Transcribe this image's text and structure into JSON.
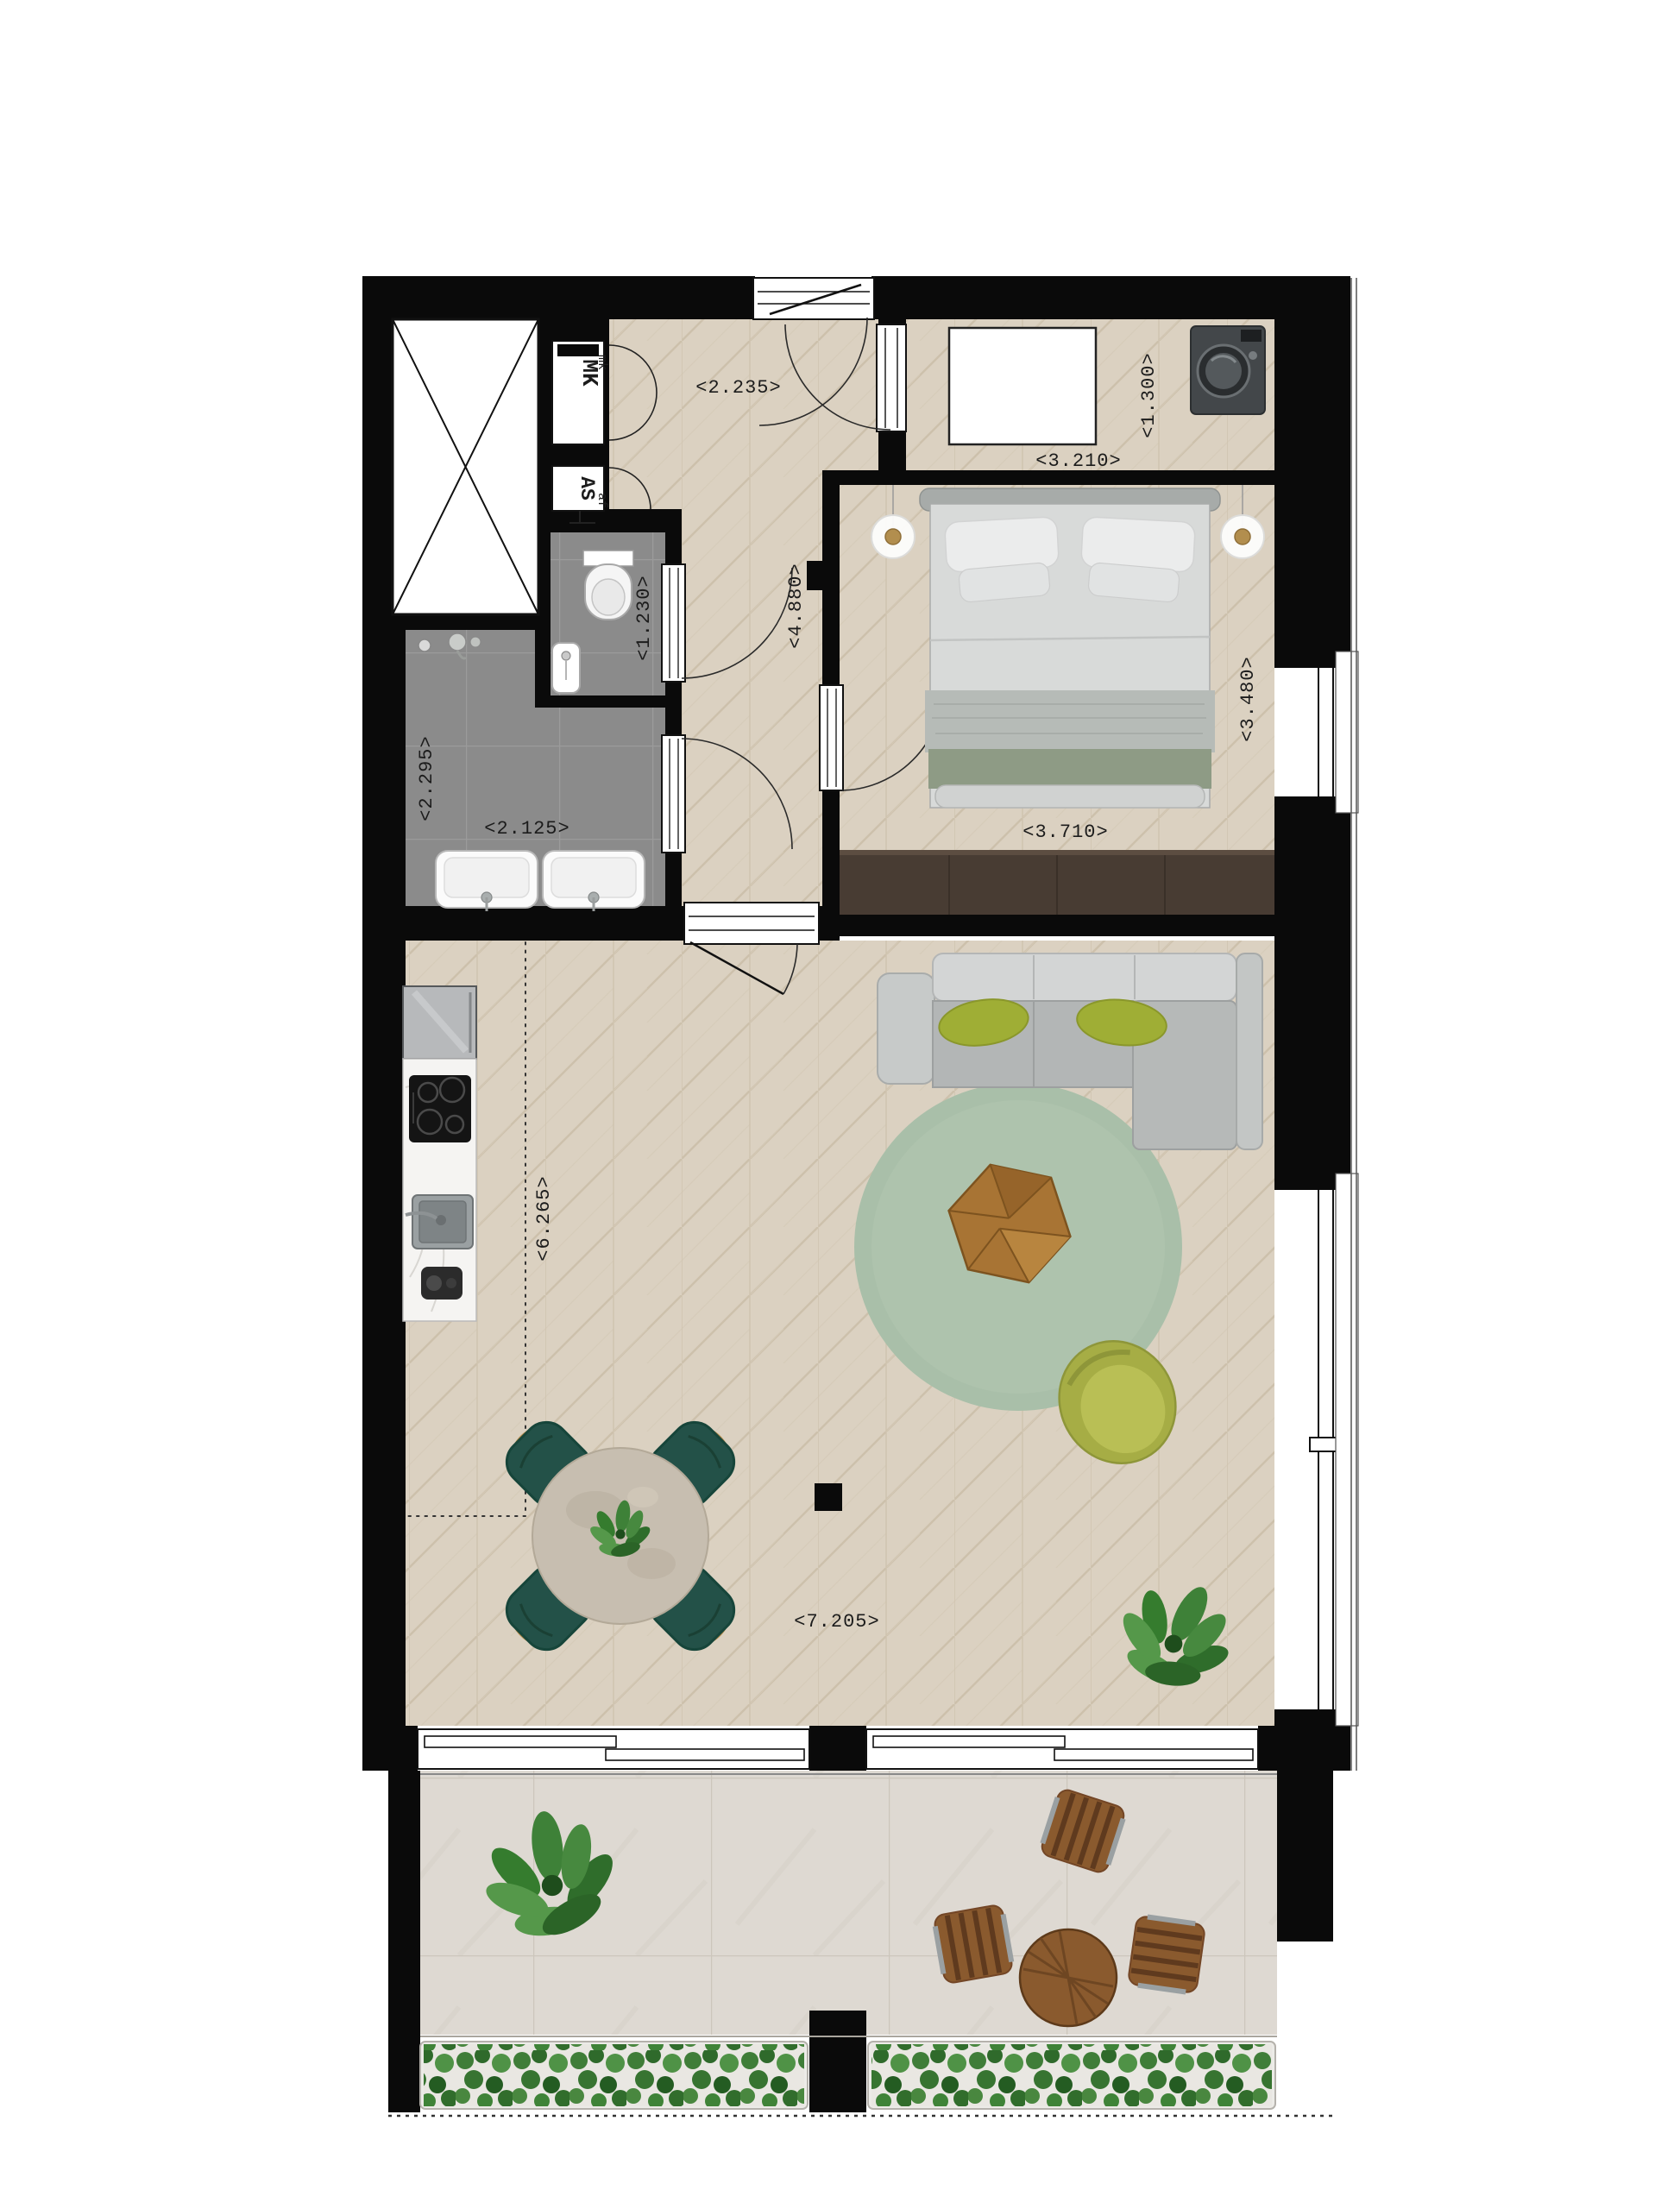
{
  "plan": {
    "dimensions": {
      "hall_width": "<2.235>",
      "laundry_width": "<3.210>",
      "laundry_depth": "<1.300>",
      "hall_length": "<4.880>",
      "wc_width": "<1.230>",
      "bathroom_length": "<2.295>",
      "bathroom_width": "<2.125>",
      "bedroom_depth": "<3.480>",
      "bedroom_width": "<3.710>",
      "kitchen_zone_length": "<6.265>",
      "living_width": "<7.205>"
    },
    "labels": {
      "meter_cupboard": "MK",
      "meter_cupboard_small": "mk",
      "shaft": "AS",
      "shaft_small": "af"
    },
    "colors": {
      "wall": "#0a0a0a",
      "wood": "#dbd1c1",
      "wood_line": "#c9bda8",
      "bath_tile": "#8b8b8b",
      "balcony_stone": "#ded9d2",
      "rug": "#a9bfa9",
      "sofa": "#b5b8b8",
      "pillow_green": "#9fae35",
      "dining_chair": "#235148",
      "dining_table": "#c7beb0",
      "coffee_table": "#a87434",
      "armchair": "#a6ad45",
      "wardrobe": "#483c33",
      "bed_blanket": "#8e9b85",
      "plant_green": "#3e8138"
    }
  }
}
